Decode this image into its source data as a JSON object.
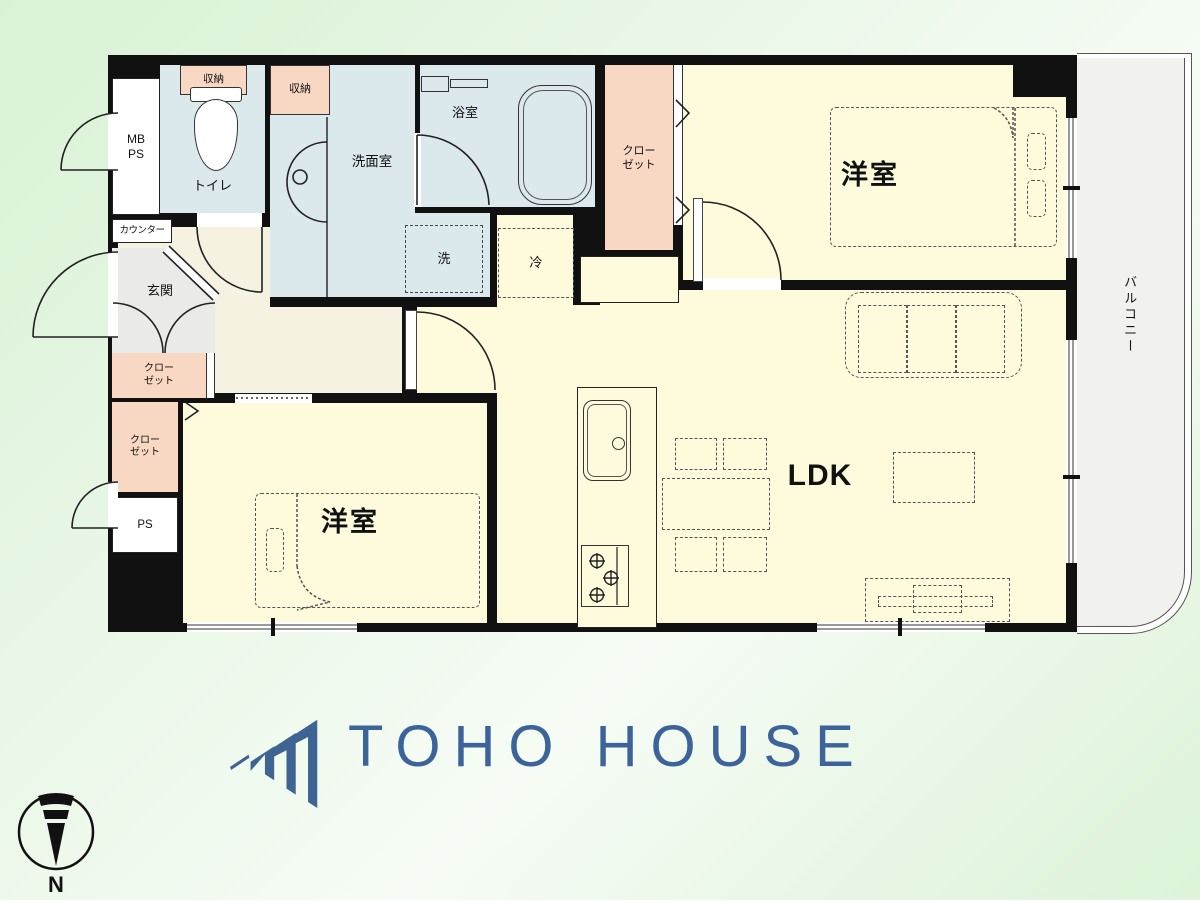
{
  "logo": {
    "text": "TOHO HOUSE",
    "color": "#3c649a"
  },
  "compass": {
    "north": "N"
  },
  "rooms": {
    "bedroom1": "洋室",
    "bedroom2": "洋室",
    "ldk": "LDK",
    "balcony": "バルコニー",
    "entrance": "玄関",
    "toilet": "トイレ",
    "washroom": "洗面室",
    "bathroom": "浴室",
    "counter": "カウンター",
    "storage_a": "収納",
    "storage_b": "収納",
    "closet_top": {
      "l1": "クロー",
      "l2": "ゼット"
    },
    "closet_mid": {
      "l1": "クロー",
      "l2": "ゼット"
    },
    "closet_low": {
      "l1": "クロー",
      "l2": "ゼット"
    },
    "washer": "洗",
    "fridge": "冷",
    "mb": {
      "l1": "MB",
      "l2": "PS"
    },
    "ps": "PS"
  },
  "colors": {
    "room": "#fdfbdc",
    "water": "#dbe8ec",
    "closet": "#f8d8c3",
    "hall": "#f6f2e2",
    "entrance_floor": "#eaeae8",
    "balcony_floor": "#f1f1f0",
    "wall": "#111111",
    "logo_blue": "#3c649a"
  }
}
